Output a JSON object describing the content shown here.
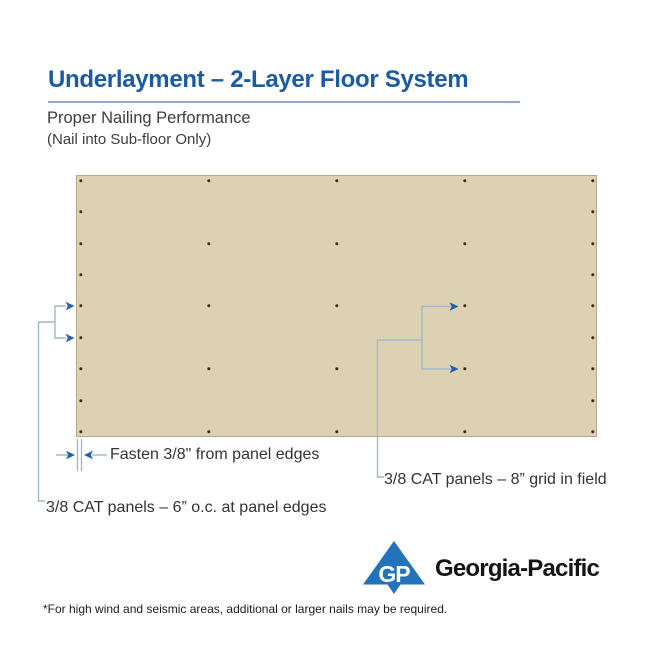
{
  "header": {
    "title": "Underlayment – 2-Layer Floor System",
    "subtitle": "Proper Nailing Performance",
    "subtitle2": "(Nail into Sub-floor Only)"
  },
  "annotations": {
    "fasten": "Fasten 3/8\" from panel edges",
    "edges": "3/8 CAT panels – 6” o.c. at panel edges",
    "field": "3/8 CAT panels – 8” grid in field"
  },
  "footnote": "*For high wind and seismic areas, additional or larger nails may be required.",
  "logo": {
    "monogram": "GP",
    "wordmark": "Georgia-Pacific"
  },
  "colors": {
    "accent_blue": "#1b5aa5",
    "underline": "#8cacd2",
    "panel_fill": "#dcd1b3",
    "panel_border": "#b4a98c",
    "nail": "#352c21",
    "leader": "#9fb9ce",
    "arrow": "#1d5fa8",
    "logo_blue": "#2273b9"
  },
  "diagram": {
    "nails": [
      [
        81,
        181
      ],
      [
        81,
        212
      ],
      [
        81,
        244
      ],
      [
        81,
        275
      ],
      [
        81,
        306
      ],
      [
        81,
        338
      ],
      [
        81,
        369
      ],
      [
        81,
        401
      ],
      [
        81,
        432
      ],
      [
        593,
        181
      ],
      [
        593,
        212
      ],
      [
        593,
        244
      ],
      [
        593,
        275
      ],
      [
        593,
        306
      ],
      [
        593,
        338
      ],
      [
        593,
        369
      ],
      [
        593,
        401
      ],
      [
        593,
        432
      ],
      [
        209,
        181
      ],
      [
        209,
        244
      ],
      [
        209,
        306
      ],
      [
        209,
        369
      ],
      [
        209,
        432
      ],
      [
        337,
        181
      ],
      [
        337,
        244
      ],
      [
        337,
        306
      ],
      [
        337,
        369
      ],
      [
        337,
        432
      ],
      [
        465,
        181
      ],
      [
        465,
        244
      ],
      [
        465,
        306
      ],
      [
        465,
        369
      ],
      [
        465,
        432
      ]
    ]
  }
}
